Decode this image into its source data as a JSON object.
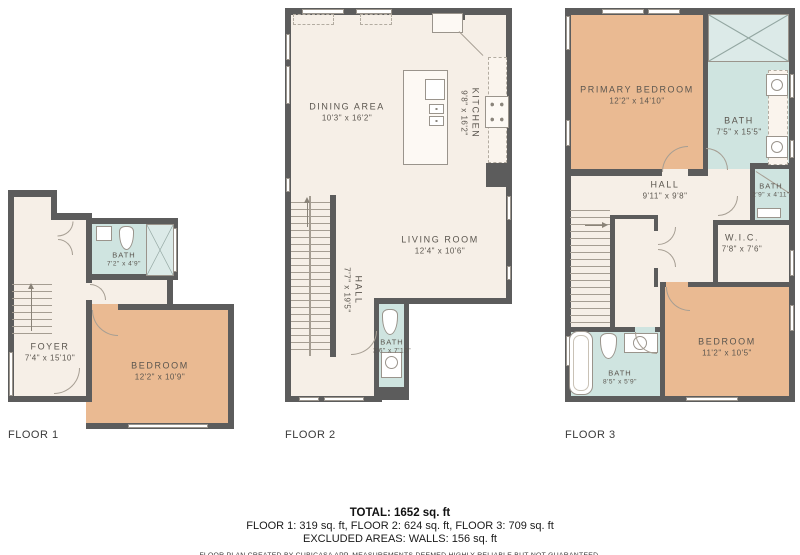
{
  "floors": [
    {
      "label": "FLOOR 1",
      "rooms": [
        {
          "name": "FOYER",
          "dims": "7'4\" x 15'10\""
        },
        {
          "name": "BATH",
          "dims": "7'2\" x 4'9\""
        },
        {
          "name": "BEDROOM",
          "dims": "12'2\" x 10'9\""
        }
      ]
    },
    {
      "label": "FLOOR 2",
      "rooms": [
        {
          "name": "DINING AREA",
          "dims": "10'3\" x 16'2\""
        },
        {
          "name": "KITCHEN",
          "dims": "9'8\" x 16'2\""
        },
        {
          "name": "LIVING ROOM",
          "dims": "12'4\" x 10'6\""
        },
        {
          "name": "HALL",
          "dims": "7'7\" x 19'5\""
        },
        {
          "name": "BATH",
          "dims": "2'6\" x 7'10\""
        }
      ]
    },
    {
      "label": "FLOOR 3",
      "rooms": [
        {
          "name": "PRIMARY BEDROOM",
          "dims": "12'2\" x 14'10\""
        },
        {
          "name": "BATH",
          "dims": "7'5\" x 15'5\""
        },
        {
          "name": "BATH",
          "dims": "2'9\" x 4'11\""
        },
        {
          "name": "HALL",
          "dims": "9'11\" x 9'8\""
        },
        {
          "name": "W.I.C.",
          "dims": "7'8\" x 7'6\""
        },
        {
          "name": "BEDROOM",
          "dims": "11'2\" x 10'5\""
        },
        {
          "name": "BATH",
          "dims": "8'5\" x 5'9\""
        }
      ]
    }
  ],
  "summary": {
    "total": "TOTAL: 1652 sq. ft",
    "per_floor": "FLOOR 1: 319 sq. ft, FLOOR 2: 624 sq. ft, FLOOR 3: 709 sq. ft",
    "excluded": "EXCLUDED AREAS: WALLS: 156 sq. ft",
    "disclaimer": "FLOOR PLAN CREATED BY CUBICASA APP. MEASUREMENTS DEEMED HIGHLY RELIABLE BUT NOT GUARANTEED."
  },
  "colors": {
    "wall": "#5c5c5c",
    "floor": "#f6efe7",
    "bedroom": "#eaba92",
    "bath": "#cfe4e0",
    "label_text": "#5b564f"
  }
}
